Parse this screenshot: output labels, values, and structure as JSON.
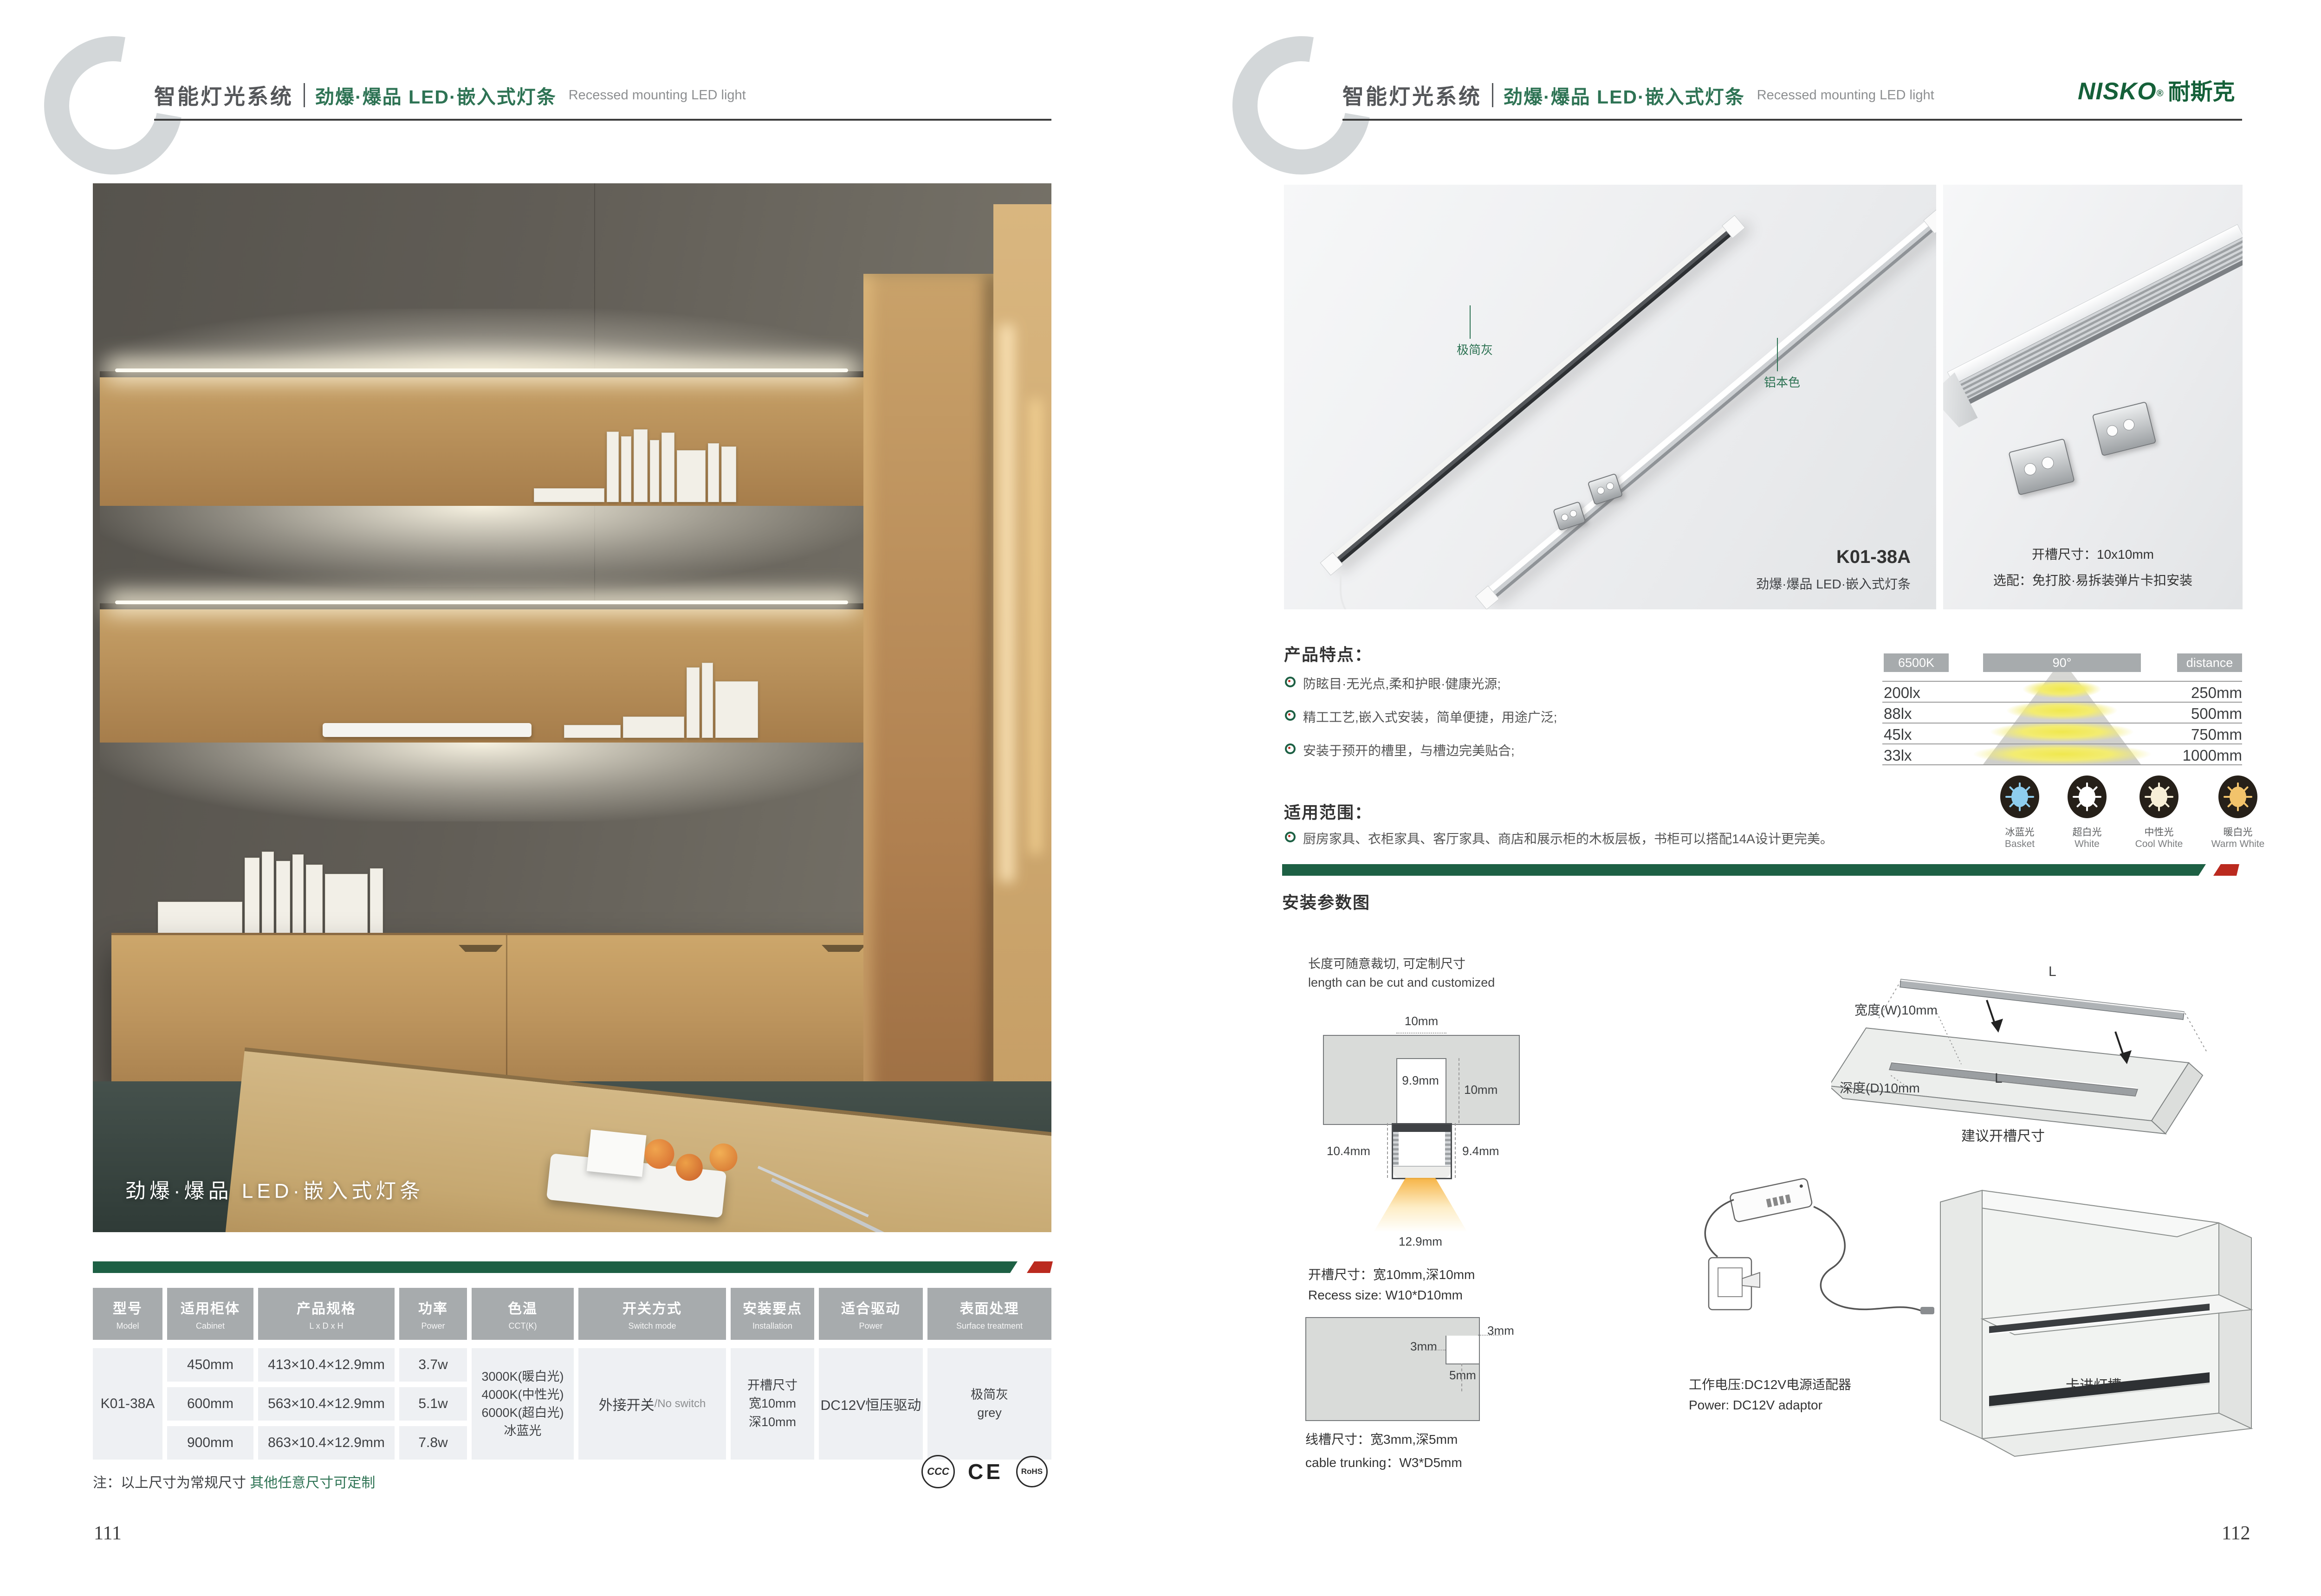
{
  "brand": {
    "logo": "NISKO",
    "logo_cn": "耐斯克",
    "reg": "®"
  },
  "header": {
    "system": "智能灯光系统",
    "category": "劲爆·爆品 LED·嵌入式灯条",
    "category_en": "Recessed mounting LED light"
  },
  "colors": {
    "brand_green": "#1d6044",
    "accent_red": "#bb2a1f",
    "table_header_gray": "#a7abad",
    "cell_gray": "#eef0f3",
    "warm_light": "#f6b33c"
  },
  "left_page": {
    "photo_caption": "劲爆·爆品 LED·嵌入式灯条",
    "table": {
      "columns": [
        {
          "cn": "型号",
          "en": "Model"
        },
        {
          "cn": "适用柜体",
          "en": "Cabinet"
        },
        {
          "cn": "产品规格",
          "en": "L x D x H"
        },
        {
          "cn": "功率",
          "en": "Power"
        },
        {
          "cn": "色温",
          "en": "CCT(K)"
        },
        {
          "cn": "开关方式",
          "en": "Switch mode"
        },
        {
          "cn": "安装要点",
          "en": "Installation"
        },
        {
          "cn": "适合驱动",
          "en": "Power"
        },
        {
          "cn": "表面处理",
          "en": "Surface treatment"
        }
      ],
      "model": "K01-38A",
      "rows": [
        {
          "cabinet": "450mm",
          "size": "413×10.4×12.9mm",
          "power": "3.7w"
        },
        {
          "cabinet": "600mm",
          "size": "563×10.4×12.9mm",
          "power": "5.1w"
        },
        {
          "cabinet": "900mm",
          "size": "863×10.4×12.9mm",
          "power": "7.8w"
        }
      ],
      "cct": [
        "3000K(暖白光)",
        "4000K(中性光)",
        "6000K(超白光)",
        "冰蓝光"
      ],
      "switch_cn": "外接开关",
      "switch_en": "/No switch",
      "install_lines": [
        "开槽尺寸",
        "宽10mm",
        "深10mm"
      ],
      "driver": "DC12V恒压驱动",
      "surface": [
        "极简灰",
        "grey"
      ]
    },
    "note": {
      "black": "注：以上尺寸为常规尺寸 ",
      "green": "其他任意尺寸可定制"
    },
    "certs": [
      "CCC",
      "CE",
      "RoHS"
    ],
    "page_number": "111"
  },
  "right_page": {
    "photo_main": {
      "label_grey": "极简灰",
      "label_aluminum": "铝本色",
      "model": "K01-38A",
      "caption": "劲爆·爆品 LED·嵌入式灯条"
    },
    "photo_detail": {
      "line1": "开槽尺寸：10x10mm",
      "line2": "选配：免打胶·易拆装弹片卡扣安装"
    },
    "features": {
      "title": "产品特点：",
      "items": [
        "防眩目·无光点,柔和护眼·健康光源;",
        "精工工艺,嵌入式安装，简单便捷，用途广泛;",
        "安装于预开的槽里，与槽边完美贴合;"
      ]
    },
    "scope": {
      "title": "适用范围：",
      "item": "厨房家具、衣柜家具、客厅家具、商店和展示柜的木板层板，书柜可以搭配14A设计更完美。"
    },
    "light_chart": {
      "col_headers": [
        "6500K",
        "90°",
        "distance"
      ],
      "rows": [
        {
          "lux": "200lx",
          "distance": "250mm"
        },
        {
          "lux": "88lx",
          "distance": "500mm"
        },
        {
          "lux": "45lx",
          "distance": "750mm"
        },
        {
          "lux": "33lx",
          "distance": "1000mm"
        }
      ]
    },
    "color_temps": [
      {
        "cn": "冰蓝光",
        "en": "Basket",
        "color": "#8ecdee"
      },
      {
        "cn": "超白光",
        "en": "White",
        "color": "#ffffff"
      },
      {
        "cn": "中性光",
        "en": "Cool White",
        "color": "#f7eed6"
      },
      {
        "cn": "暖白光",
        "en": "Warm White",
        "color": "#f2c36b"
      }
    ],
    "install": {
      "title": "安装参数图",
      "cut_cn": "长度可随意裁切, 可定制尺寸",
      "cut_en": "length can be cut and customized",
      "dim_top": "10mm",
      "dim_inner": "9.9mm",
      "dim_depth": "10mm",
      "dim_left": "10.4mm",
      "dim_right": "9.4mm",
      "dim_bottom": "12.9mm",
      "recess_cn": "开槽尺寸：宽10mm,深10mm",
      "recess_en": "Recess size: W10*D10mm",
      "trunk_dim_a": "3mm",
      "trunk_dim_b": "3mm",
      "trunk_dim_c": "5mm",
      "trunk_cn": "线槽尺寸：宽3mm,深5mm",
      "trunk_en": "cable trunking：W3*D5mm",
      "board_L_top": "L",
      "board_L_groove": "L",
      "board_width": "宽度(W)10mm",
      "board_depth": "深度(D)10mm",
      "board_caption": "建议开槽尺寸",
      "power_cn": "工作电压:DC12V电源适配器",
      "power_en": "Power: DC12V adaptor",
      "clip_label": "卡进灯槽"
    },
    "page_number": "112"
  }
}
